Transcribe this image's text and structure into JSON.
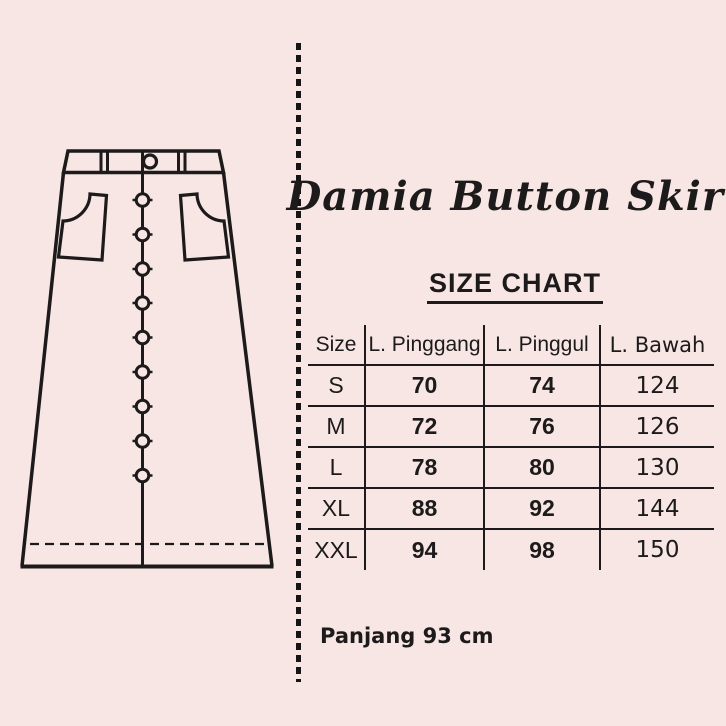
{
  "product_title": "Damia Button Skirt",
  "chart_data": {
    "type": "table",
    "title": "SIZE CHART",
    "columns": [
      "Size",
      "L. Pinggang",
      "L. Pinggul",
      "L. Bawah"
    ],
    "rows": [
      [
        "S",
        70,
        74,
        124
      ],
      [
        "M",
        72,
        76,
        126
      ],
      [
        "L",
        78,
        80,
        130
      ],
      [
        "XL",
        88,
        92,
        144
      ],
      [
        "XXL",
        94,
        98,
        150
      ]
    ],
    "note": "Panjang 93 cm",
    "layout": "grid lines between rows and columns, no outer border, title underlined"
  },
  "illustration": {
    "name": "button-front A-line skirt line drawing",
    "button_count": 9
  },
  "colors": {
    "background": "#F7E6E4",
    "ink": "#1C1A1A"
  }
}
